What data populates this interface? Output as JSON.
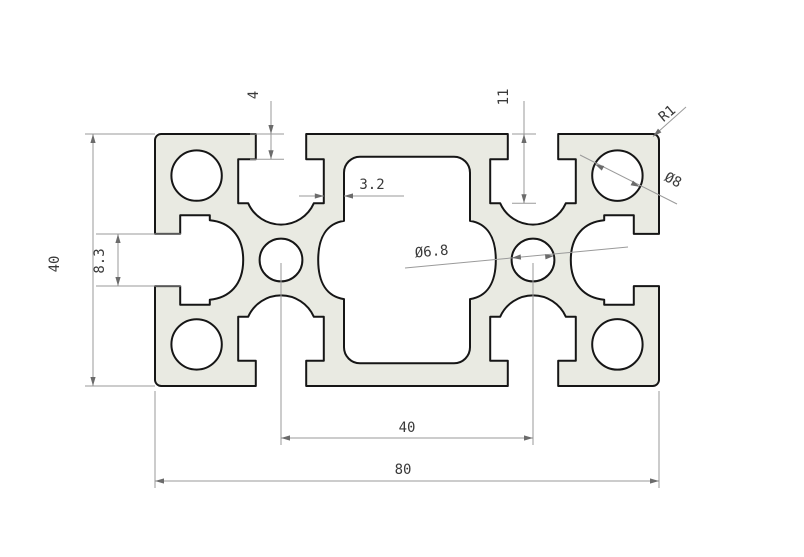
{
  "drawing": {
    "kind": "technical-drawing",
    "subject": "aluminium-extrusion-profile-cross-section-80x40",
    "dimensions": {
      "height": "40",
      "end_slot_opening": "8.3",
      "slot_mouth_depth": "4",
      "slot_cavity_depth": "11",
      "wall_thickness": "3.2",
      "center_hole_dia": "Ø6.8",
      "corner_hole_dia": "Ø8",
      "corner_radius": "R1",
      "hole_spacing": "40",
      "width": "80"
    },
    "colors": {
      "material_fill": "#e9eae2",
      "outline": "#161616",
      "dimension_lines": "#9a9a9a",
      "dimension_text": "#3a3a3a",
      "background": "#ffffff"
    }
  }
}
